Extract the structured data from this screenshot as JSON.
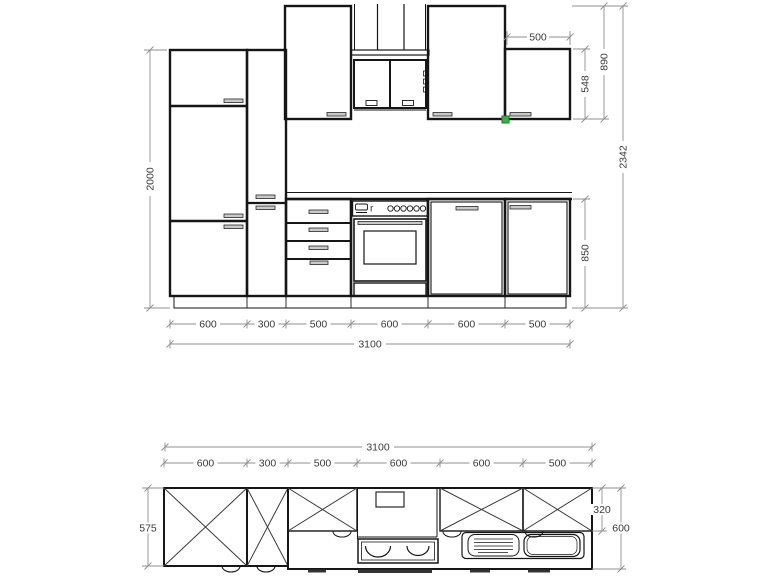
{
  "drawing": {
    "type": "kitchen cabinet technical drawing, front elevation and plan view",
    "colors": {
      "cabinet_line": "#161616",
      "dimension_line": "#8f8f8f",
      "dimension_text": "#3a3a3a",
      "selection_grip": "#3bb143"
    },
    "elevation": {
      "dims": {
        "tall_height": "2000",
        "short_wall_cab_width": "500",
        "short_wall_cab_height": "548",
        "wall_cab_height": "890",
        "total_height": "2342",
        "base_height": "850",
        "unit_widths": [
          "600",
          "300",
          "500",
          "600",
          "600",
          "500"
        ],
        "total_width": "3100"
      },
      "oven_panel_label": "r"
    },
    "plan": {
      "dims": {
        "total_width": "3100",
        "unit_widths": [
          "600",
          "300",
          "500",
          "600",
          "600",
          "500"
        ],
        "tall_unit_depth": "575",
        "wall_cab_depth": "320",
        "worktop_depth": "600"
      }
    }
  }
}
